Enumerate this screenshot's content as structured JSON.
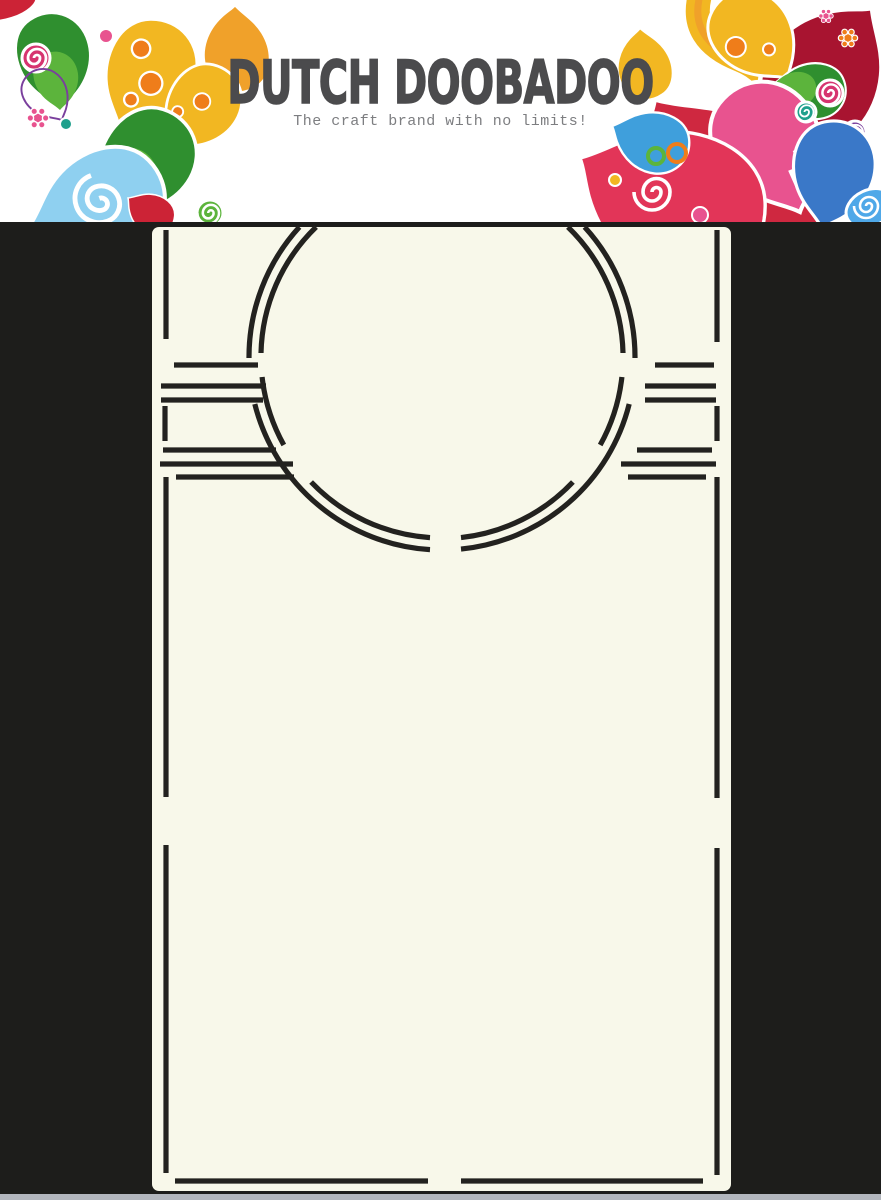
{
  "banner": {
    "title": "DUTCH DOOBADOO",
    "tagline": "The craft brand with no limits!"
  },
  "product": {
    "type": "stencil-template-photo"
  },
  "colors": {
    "banner-bg": "#ffffff",
    "title": "#4b4b4d",
    "tagline": "#7d7e81",
    "photo-bg": "#1d1d1b",
    "card": "#f8f8ea",
    "cut": "#23221f",
    "bottom-strip": "#b2b6bd",
    "p-gold": "#f2b722",
    "p-gold2": "#f0a12a",
    "p-orange": "#ef7d1a",
    "p-green": "#2f8f2f",
    "p-green-light": "#5cb43c",
    "p-teal": "#1fa08c",
    "p-blue-light": "#8fd0f0",
    "p-blue": "#3f9fdc",
    "p-blue-deep": "#3a78c8",
    "p-magenta": "#d6346f",
    "p-pink": "#e8538f",
    "p-red": "#cc2336",
    "p-red-deep": "#a81430",
    "p-purple": "#7a3f9d"
  }
}
